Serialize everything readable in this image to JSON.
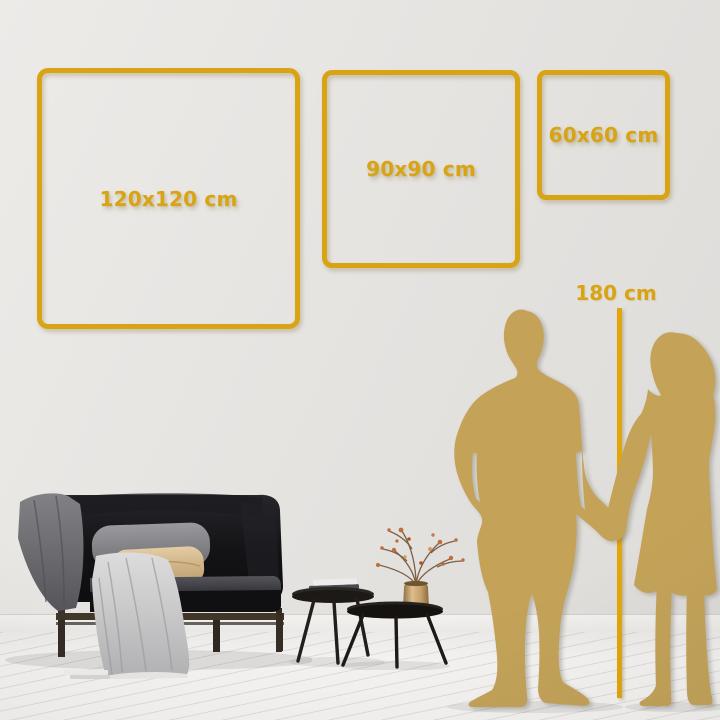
{
  "size_frames": [
    {
      "label": "120x120 cm"
    },
    {
      "label": "90x90 cm"
    },
    {
      "label": "60x60 cm"
    }
  ],
  "height_marker": {
    "label": "180 cm"
  },
  "colors": {
    "frame_gold": "#D9A414",
    "line_gold": "#E2A60D",
    "silhouette_gold": "#C4A358",
    "wall": "#E4E2DF",
    "floor": "#F4F3F1"
  }
}
